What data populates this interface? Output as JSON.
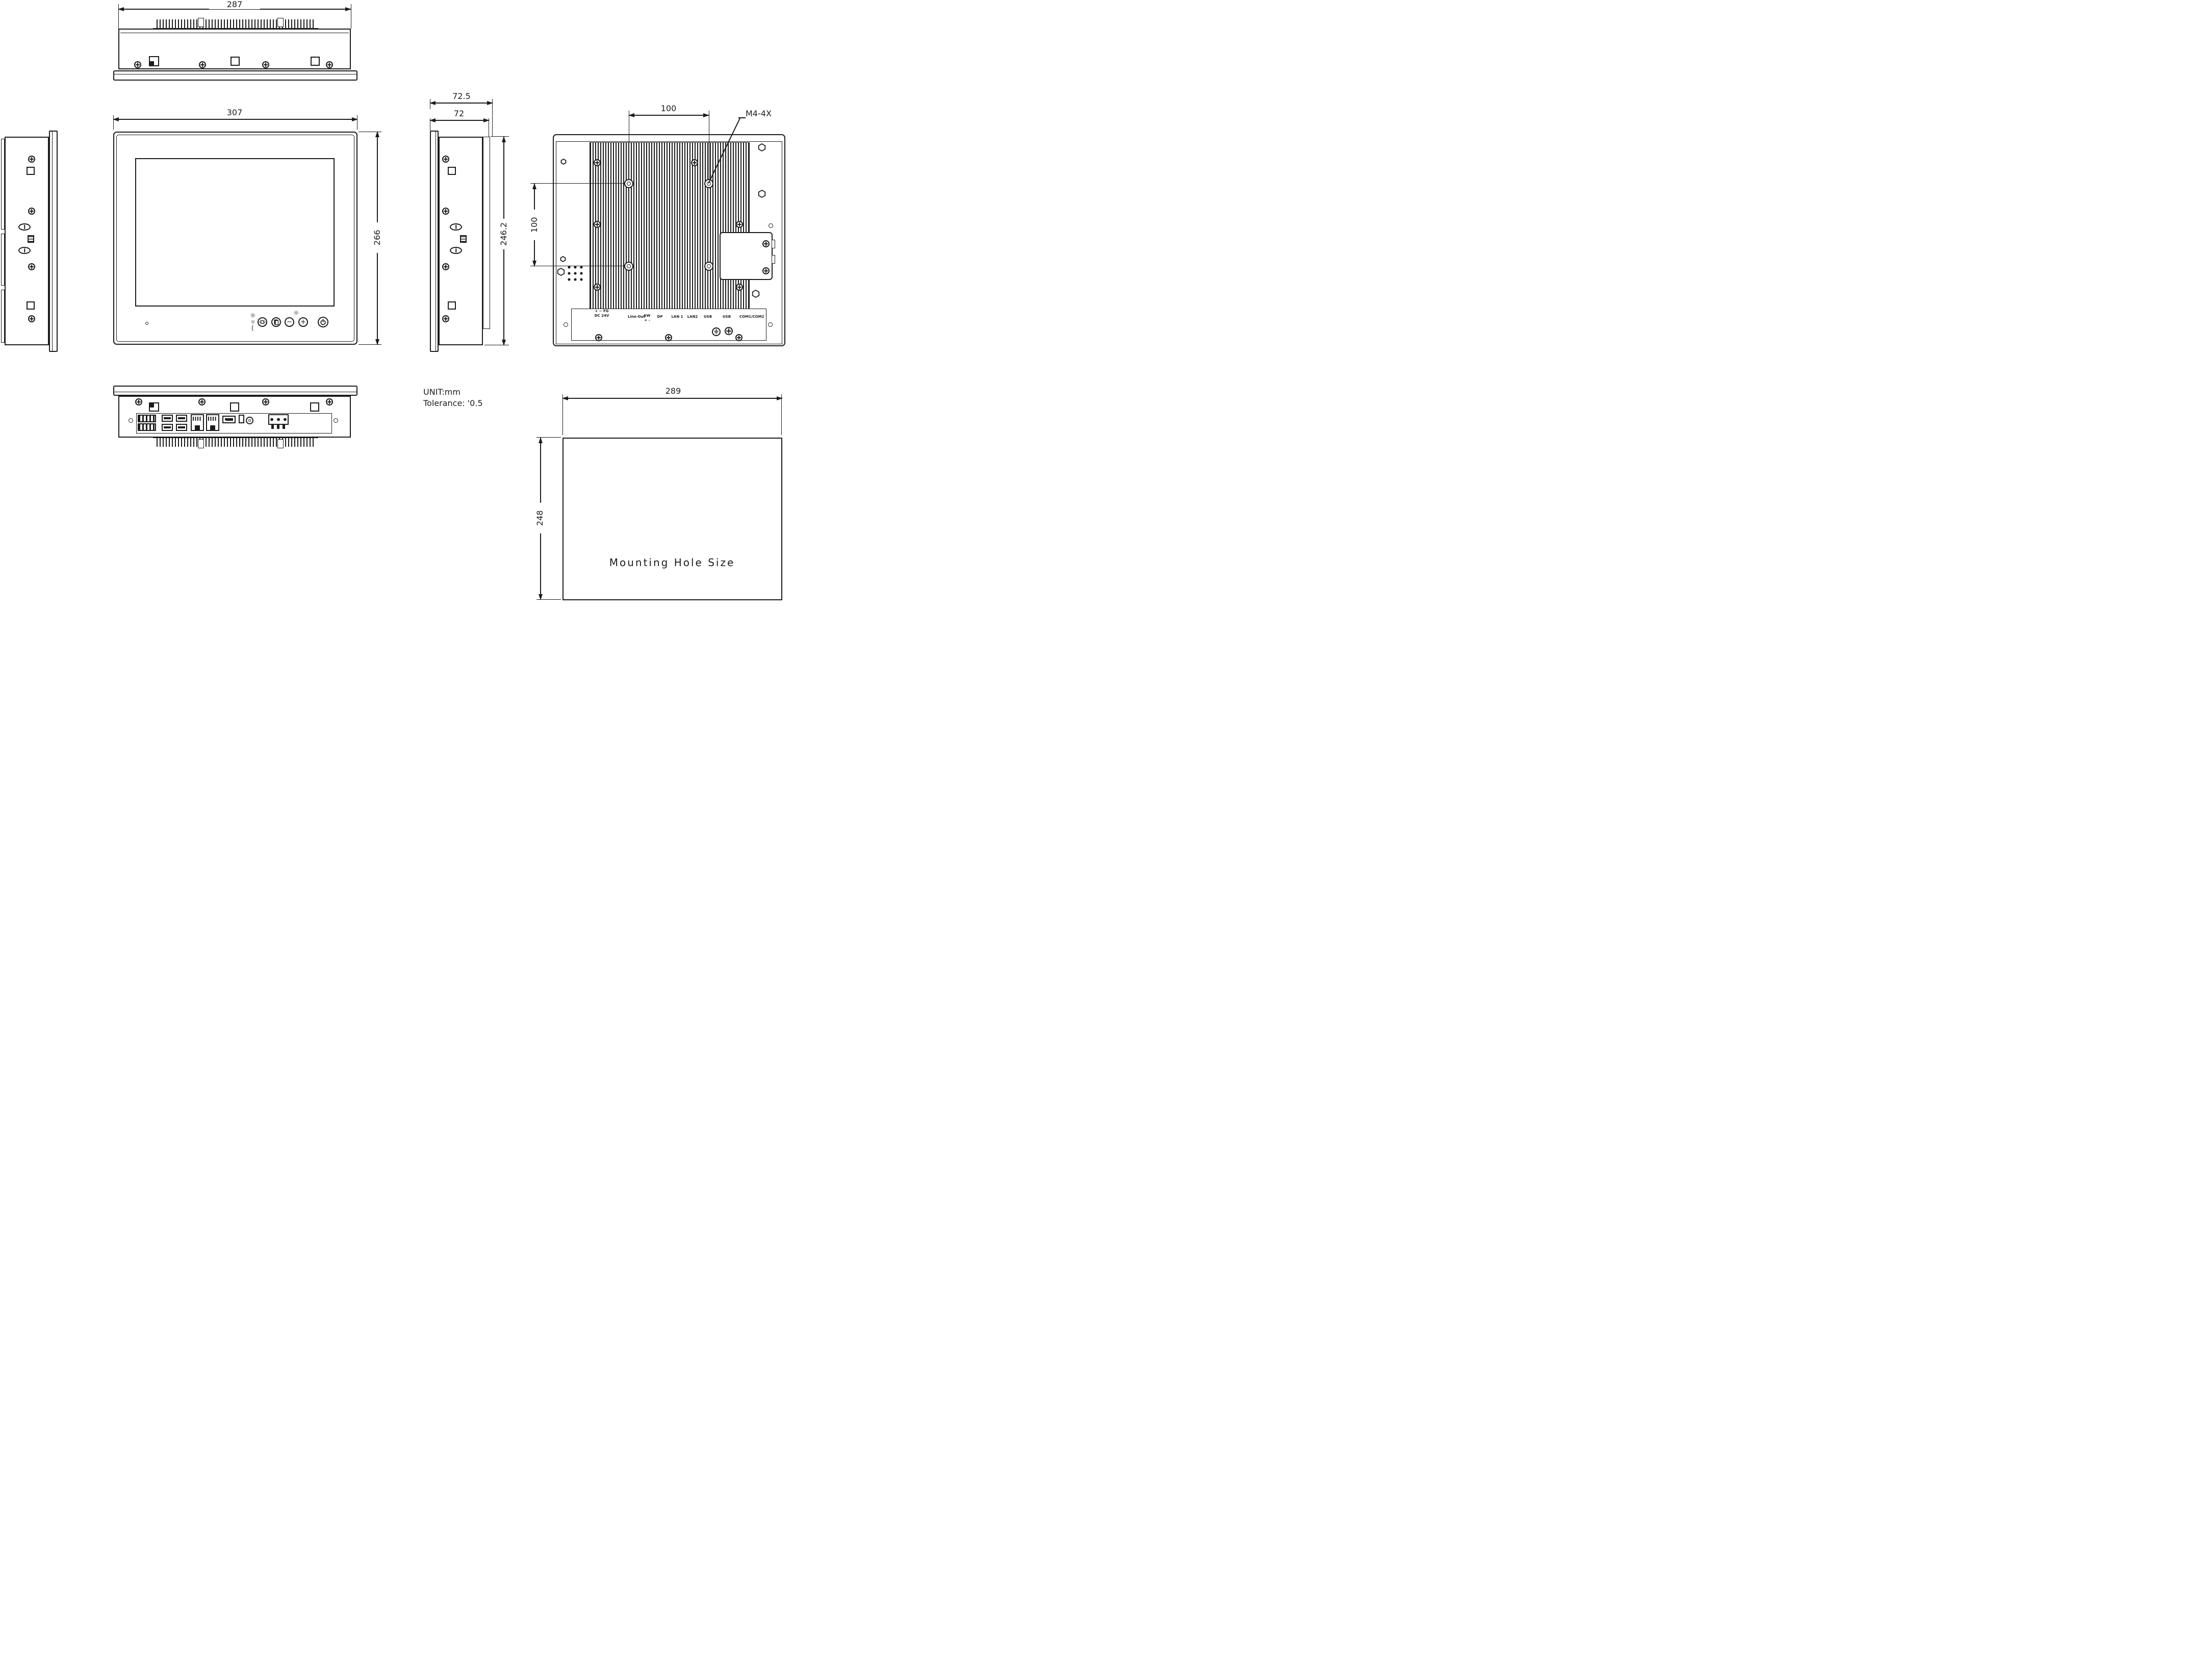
{
  "colors": {
    "line": "#1c1c1c",
    "background": "#ffffff"
  },
  "dimensions": {
    "top_width": "287",
    "front_width": "307",
    "front_height": "266",
    "depth_total": "72.5",
    "depth_body": "72",
    "rear_height": "246.2",
    "vesa_horizontal": "100",
    "vesa_vertical": "100",
    "vesa_thread_label": "M4-4X",
    "cutout_width": "289",
    "cutout_height": "248"
  },
  "notes": {
    "unit": "UNIT:mm",
    "tolerance": "Tolerance:  '0.5",
    "mounting_caption": "Mounting Hole Size"
  },
  "front_controls": {
    "sun": "☼",
    "crescent": "(",
    "minus": "−",
    "plus": "+"
  },
  "rear_ports": {
    "power_polarity": "+  −  FG",
    "power": "DC 24V",
    "line_out": "Line-Out",
    "sw": "SW",
    "sw_polarity": "+    -",
    "dp": "DP",
    "lan1": "LAN 1",
    "lan2": "LAN2",
    "usb_a": "USB",
    "usb_b": "USB",
    "com": "COM1/COM2"
  }
}
